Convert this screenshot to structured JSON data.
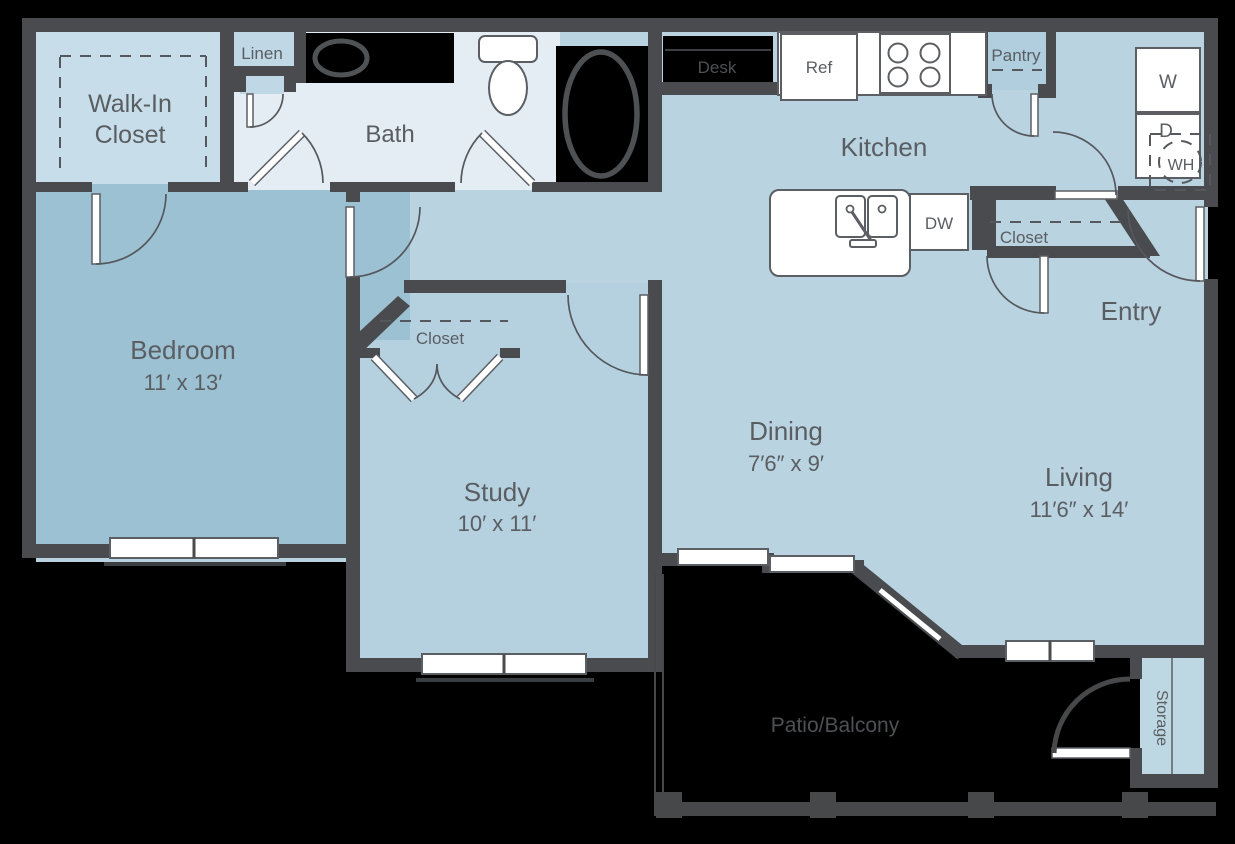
{
  "plan": {
    "rooms": {
      "walk_in_closet": {
        "label_line1": "Walk-In",
        "label_line2": "Closet"
      },
      "linen": {
        "label": "Linen"
      },
      "bath": {
        "label": "Bath"
      },
      "bedroom": {
        "label": "Bedroom",
        "dims": "11′ x 13′"
      },
      "study": {
        "label": "Study",
        "dims": "10′ x 11′"
      },
      "study_closet": {
        "label": "Closet"
      },
      "dining": {
        "label": "Dining",
        "dims": "7′6″ x 9′"
      },
      "living": {
        "label": "Living",
        "dims": "11′6″ x 14′"
      },
      "kitchen": {
        "label": "Kitchen"
      },
      "entry": {
        "label": "Entry"
      },
      "entry_closet": {
        "label": "Closet"
      },
      "pantry": {
        "label": "Pantry"
      },
      "desk": {
        "label": "Desk"
      },
      "patio": {
        "label": "Patio/Balcony"
      },
      "storage": {
        "label": "Storage"
      }
    },
    "appliances": {
      "refrigerator": "Ref",
      "dishwasher": "DW",
      "washer": "W",
      "dryer": "D",
      "water_heater": "WH"
    },
    "colors": {
      "wall": "#494b4e",
      "main_floor": "#b9d3e1",
      "bedroom_floor": "#9cc1d3",
      "bath_floor": "#e3edf3",
      "closet_floor": "#c7dde9",
      "storage_floor": "#bdd7e3",
      "label_text": "#5a5e62",
      "background": "#000000"
    }
  }
}
